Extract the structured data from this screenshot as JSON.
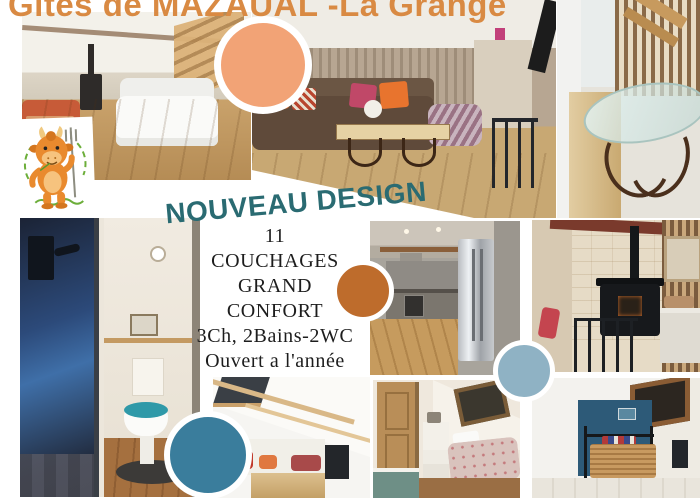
{
  "title": {
    "text": "Gîtes de MAZAUAL -La Grange"
  },
  "banner": {
    "text": "NOUVEAU DESIGN"
  },
  "info": {
    "lines": [
      "11",
      "COUCHAGES",
      "GRAND",
      "CONFORT",
      "3Ch, 2Bains-2WC",
      "Ouvert a l'année"
    ]
  },
  "logo": {
    "name": "les-gites-de-mazaual-mascot"
  },
  "colors": {
    "title_orange": "#d98a43",
    "banner_teal": "#2a6b72",
    "info_text": "#1d1d1d",
    "circle_salmon": "#f2a376",
    "circle_burnt_orange": "#be6c2c",
    "circle_light_blue": "#8fb2c4",
    "circle_teal": "#3a7d9c",
    "mascot_orange": "#e98a2e",
    "mascot_green": "#6cae3a"
  },
  "photos": [
    {
      "name": "living-room-stairs-photo"
    },
    {
      "name": "living-room-sofas-photo"
    },
    {
      "name": "dining-glass-table-photo"
    },
    {
      "name": "bathroom-shower-wc-photo"
    },
    {
      "name": "kitchen-photo"
    },
    {
      "name": "wood-stove-room-photo"
    },
    {
      "name": "attic-lounge-photo"
    },
    {
      "name": "attic-bedroom-floral-photo"
    },
    {
      "name": "attic-bedroom-blue-photo"
    }
  ]
}
